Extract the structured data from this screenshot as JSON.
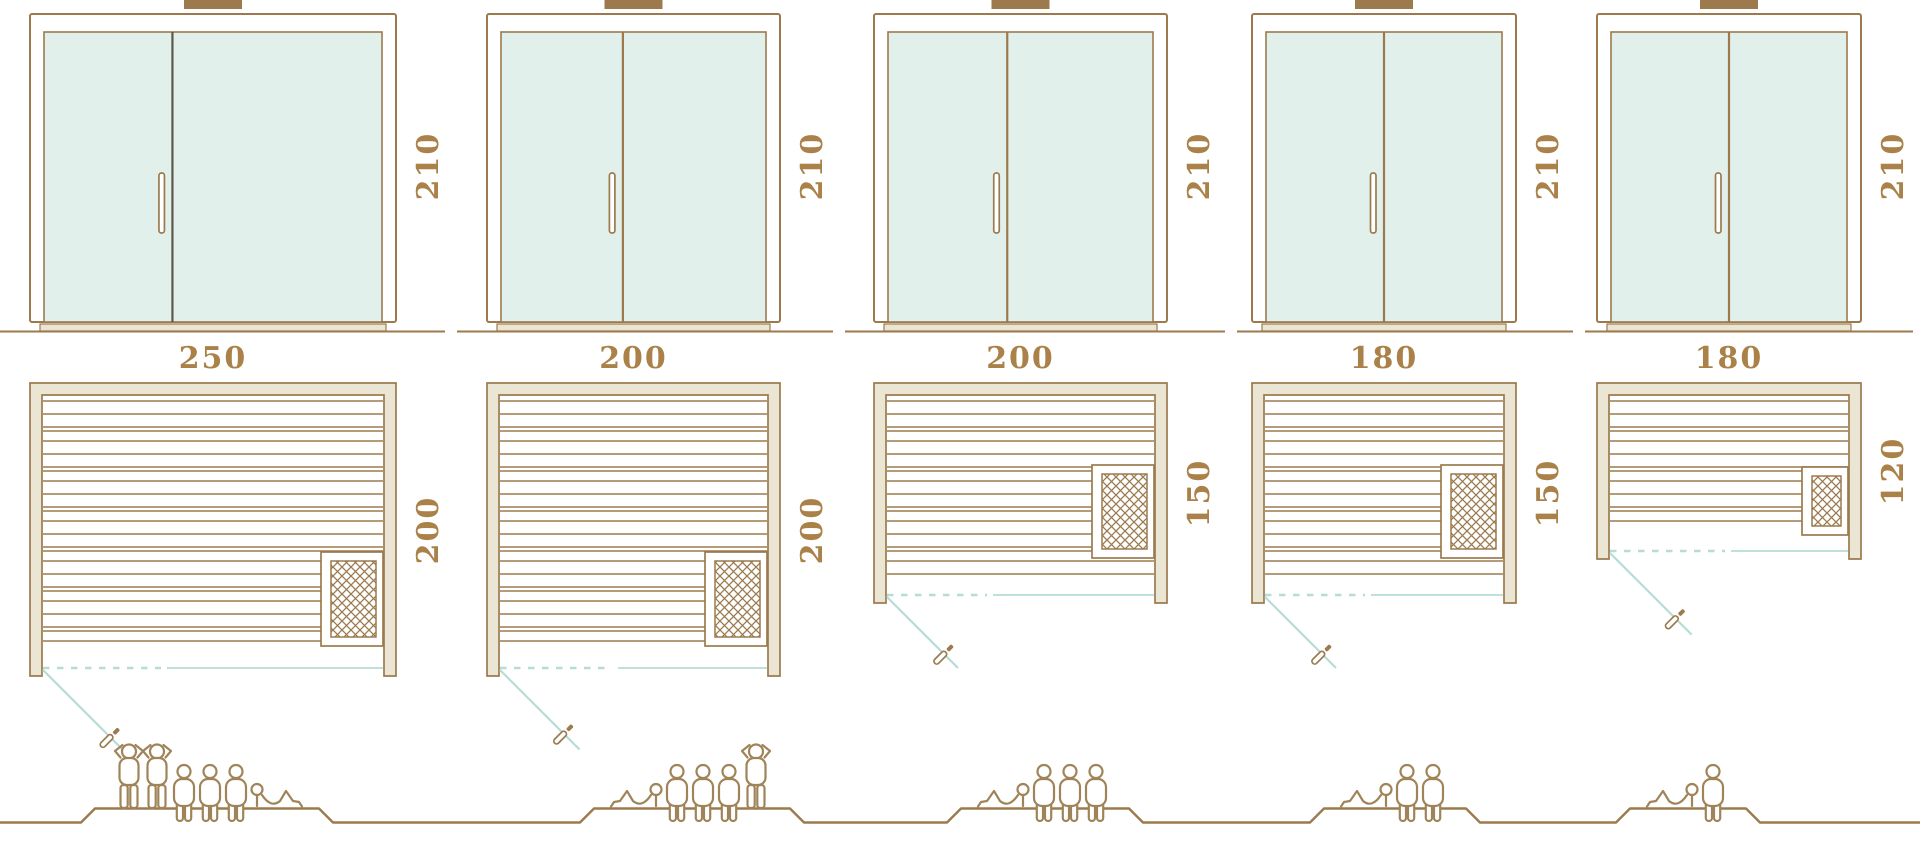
{
  "colors": {
    "line_brown": "#9c7a4e",
    "wood_beige": "#eae6d3",
    "glass_mint": "#e2f0ec",
    "swing_teal": "#b7dcd6",
    "dimension_text": "#aa8148",
    "figure_brown": "#a08459",
    "divider_dark": "#5f574a"
  },
  "units": [
    {
      "width_label": "250",
      "depth_label": "200",
      "door_height_label": "210",
      "width_cm": 250,
      "depth_cm": 200,
      "door_height_cm": 210,
      "capacity": 6,
      "figures": [
        "standing",
        "standing",
        "seated",
        "seated",
        "seated",
        "lying"
      ]
    },
    {
      "width_label": "200",
      "depth_label": "200",
      "door_height_label": "210",
      "width_cm": 200,
      "depth_cm": 200,
      "door_height_cm": 210,
      "capacity": 5,
      "figures": [
        "lying",
        "seated",
        "seated",
        "seated",
        "standing"
      ]
    },
    {
      "width_label": "200",
      "depth_label": "150",
      "door_height_label": "210",
      "width_cm": 200,
      "depth_cm": 150,
      "door_height_cm": 210,
      "capacity": 4,
      "figures": [
        "lying",
        "seated",
        "seated",
        "seated"
      ]
    },
    {
      "width_label": "180",
      "depth_label": "150",
      "door_height_label": "210",
      "width_cm": 180,
      "depth_cm": 150,
      "door_height_cm": 210,
      "capacity": 3,
      "figures": [
        "lying",
        "seated",
        "seated"
      ]
    },
    {
      "width_label": "180",
      "depth_label": "120",
      "door_height_label": "210",
      "width_cm": 180,
      "depth_cm": 120,
      "door_height_cm": 210,
      "capacity": 2,
      "figures": [
        "lying",
        "seated"
      ]
    }
  ]
}
